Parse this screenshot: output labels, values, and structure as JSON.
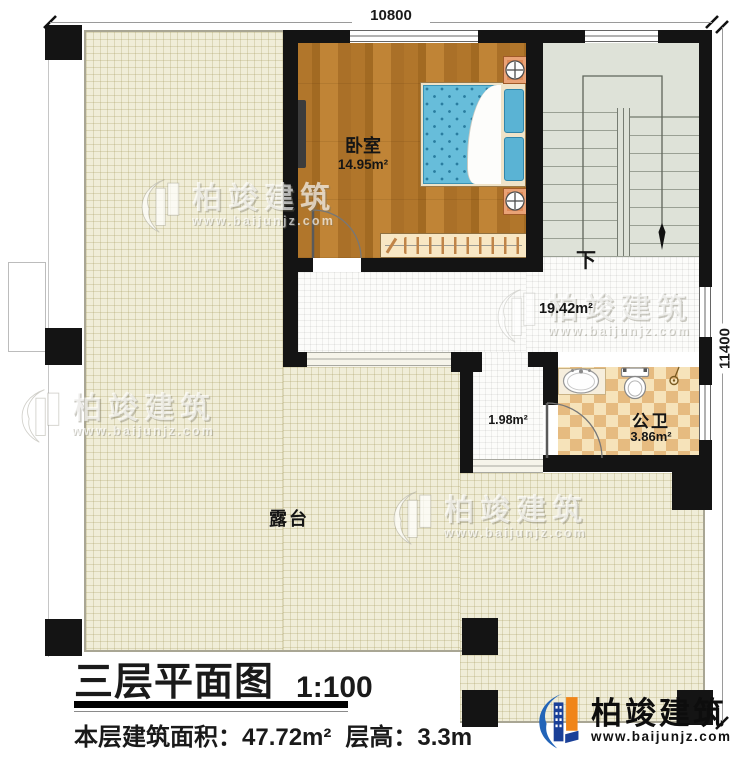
{
  "dimensions": {
    "top": "10800",
    "right": "11400"
  },
  "rooms": {
    "bedroom": {
      "name": "卧室",
      "area": "14.95m²"
    },
    "hallway": {
      "area": "19.42m²"
    },
    "stairs": {
      "direction": "下"
    },
    "corridor": {
      "area": "1.98m²"
    },
    "bathroom": {
      "name": "公卫",
      "area": "3.86m²"
    },
    "terrace": {
      "name": "露台"
    }
  },
  "title": {
    "text": "三层平面图",
    "scale": "1:100"
  },
  "subtitle": {
    "area_label": "本层建筑面积：",
    "area_value": "47.72m²",
    "height_label": "层高：",
    "height_value": "3.3m"
  },
  "branding": {
    "name": "柏竣建筑",
    "url": "www.baijunjz.com"
  },
  "colors": {
    "wall": "#141414",
    "wood": "#b1762b",
    "terrace": "#f0edd8",
    "stairs": "#dee2d8",
    "tile": "#fcfcfa",
    "checker_light": "#f6e3ba",
    "checker_dark": "#e6bb80",
    "bed": "#67bdda",
    "logo_blue": "#1a4098",
    "logo_orange": "#f08519"
  }
}
